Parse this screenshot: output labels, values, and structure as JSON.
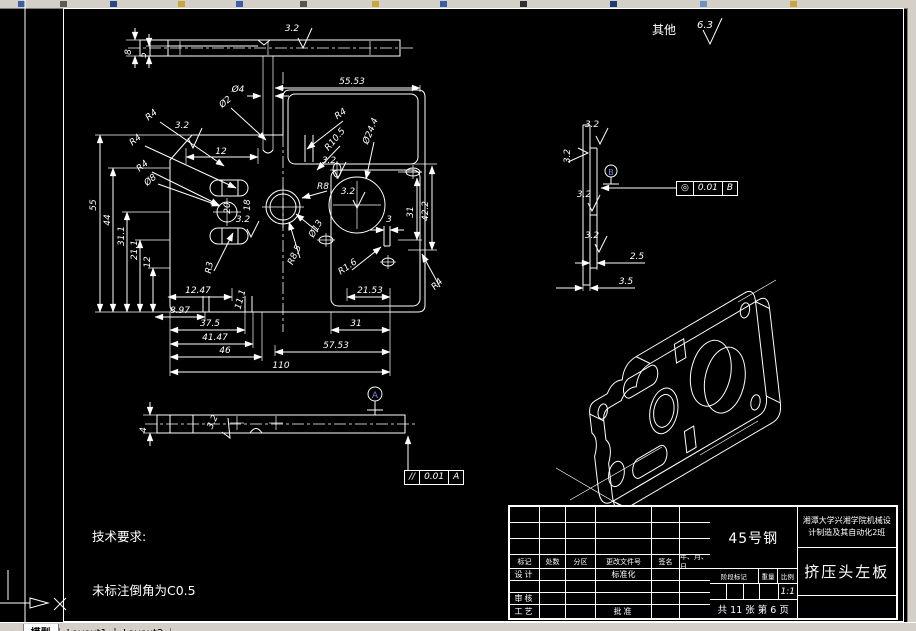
{
  "colors": {
    "line": "#ffffff",
    "bg": "#000000",
    "chrome": "#d4d0c8",
    "datum_letter": "#7a86e8"
  },
  "top_note": {
    "label": "其他",
    "roughness_value": "6.3"
  },
  "tech_req": {
    "title": "技术要求:",
    "line1": "未标注倒角为C0.5"
  },
  "tolerances": {
    "f1": {
      "symbol": "◎",
      "value": "0.01",
      "datum": "B"
    },
    "f2": {
      "symbol": "//",
      "value": "0.01",
      "datum": "A"
    }
  },
  "tabs": {
    "scroll_left": "◄",
    "scroll_right": "►",
    "items": [
      "模型",
      "Layout1",
      "Layout2"
    ]
  },
  "title_block": {
    "material": "45号钢",
    "company_line1": "湘潭大学兴湘学院机械设",
    "company_line2": "计制造及其自动化2班",
    "part_name": "挤压头左板",
    "headers": [
      "标记",
      "处数",
      "分区",
      "更改文件号",
      "签名",
      "年、月、日"
    ],
    "row_design": "设计",
    "row_standard": "标准化",
    "row_check": "审核",
    "row_process": "工艺",
    "row_approve": "批准",
    "stage_header": "阶段标记",
    "weight_header": "重量",
    "scale_header": "比例",
    "scale_value": "1:1",
    "sheet_info": "共 11 张  第 6 页"
  },
  "drawing": {
    "labels": [
      {
        "t": "其他",
        "x": 664,
        "y": 34,
        "s": 12,
        "b": 1,
        "n": "other-surfaces-label"
      },
      {
        "t": "6.3",
        "x": 705,
        "y": 28,
        "s": 10,
        "n": "default-roughness-value"
      },
      {
        "t": "8",
        "x": 131,
        "y": 52,
        "r": -90
      },
      {
        "t": "5",
        "x": 146,
        "y": 55,
        "r": -90
      },
      {
        "t": "3.2",
        "x": 292,
        "y": 31
      },
      {
        "t": "Ø4",
        "x": 238,
        "y": 92
      },
      {
        "t": "55.53",
        "x": 352,
        "y": 84
      },
      {
        "t": "12",
        "x": 221,
        "y": 154
      },
      {
        "t": "55",
        "x": 96,
        "y": 205,
        "r": -90
      },
      {
        "t": "44",
        "x": 110,
        "y": 220,
        "r": -90
      },
      {
        "t": "31.1",
        "x": 124,
        "y": 236,
        "r": -90
      },
      {
        "t": "21.1",
        "x": 137,
        "y": 250,
        "r": -90
      },
      {
        "t": "12",
        "x": 150,
        "y": 262,
        "r": -90
      },
      {
        "t": "R4",
        "x": 153,
        "y": 117,
        "r": -40
      },
      {
        "t": "R4",
        "x": 137,
        "y": 142,
        "r": -40
      },
      {
        "t": "R4",
        "x": 144,
        "y": 168,
        "r": -40
      },
      {
        "t": "3.2",
        "x": 182,
        "y": 128
      },
      {
        "t": "Ø2",
        "x": 227,
        "y": 104,
        "r": -40
      },
      {
        "t": "Ø8",
        "x": 152,
        "y": 182,
        "r": -40
      },
      {
        "t": "R4",
        "x": 342,
        "y": 116,
        "r": -35
      },
      {
        "t": "R10.5",
        "x": 337,
        "y": 141,
        "r": -50
      },
      {
        "t": "Ø24.4",
        "x": 373,
        "y": 132,
        "r": -68
      },
      {
        "t": "3.2",
        "x": 329,
        "y": 163
      },
      {
        "t": "3.2",
        "x": 348,
        "y": 194
      },
      {
        "t": "R8",
        "x": 323,
        "y": 189
      },
      {
        "t": "Ø13",
        "x": 318,
        "y": 230,
        "r": -60
      },
      {
        "t": "R8.5",
        "x": 297,
        "y": 256,
        "r": -65
      },
      {
        "t": "R1.6",
        "x": 349,
        "y": 269,
        "r": -35
      },
      {
        "t": "R4",
        "x": 439,
        "y": 286,
        "r": -45
      },
      {
        "t": "R3",
        "x": 212,
        "y": 268,
        "r": -80
      },
      {
        "t": "3.2",
        "x": 243,
        "y": 222
      },
      {
        "t": "20",
        "x": 230,
        "y": 208,
        "r": -90
      },
      {
        "t": "18",
        "x": 250,
        "y": 205,
        "r": -90
      },
      {
        "t": "11.1",
        "x": 243,
        "y": 300,
        "r": -75
      },
      {
        "t": "12.47",
        "x": 198,
        "y": 293
      },
      {
        "t": "8.97",
        "x": 180,
        "y": 313
      },
      {
        "t": "37.5",
        "x": 210,
        "y": 326
      },
      {
        "t": "41.47",
        "x": 215,
        "y": 340
      },
      {
        "t": "46",
        "x": 225,
        "y": 353
      },
      {
        "t": "110",
        "x": 281,
        "y": 368
      },
      {
        "t": "31",
        "x": 356,
        "y": 326
      },
      {
        "t": "57.53",
        "x": 336,
        "y": 348
      },
      {
        "t": "21.53",
        "x": 370,
        "y": 293
      },
      {
        "t": "3",
        "x": 389,
        "y": 222
      },
      {
        "t": "31",
        "x": 413,
        "y": 212,
        "r": -90
      },
      {
        "t": "42.2",
        "x": 428,
        "y": 211,
        "r": -90
      },
      {
        "t": "3.2",
        "x": 570,
        "y": 156,
        "r": -90
      },
      {
        "t": "3.2",
        "x": 592,
        "y": 127
      },
      {
        "t": "3.2",
        "x": 584,
        "y": 197
      },
      {
        "t": "3.2",
        "x": 592,
        "y": 238
      },
      {
        "t": "2.5",
        "x": 637,
        "y": 259
      },
      {
        "t": "3.5",
        "x": 626,
        "y": 284
      },
      {
        "t": "4",
        "x": 146,
        "y": 430,
        "r": -90
      },
      {
        "t": "3.2",
        "x": 215,
        "y": 423,
        "r": -65
      },
      {
        "t": "A",
        "x": 375,
        "y": 398,
        "s": 9,
        "b": 1,
        "c": "#7a86e8",
        "n": "datum-a-label"
      },
      {
        "t": "B",
        "x": 611,
        "y": 175,
        "s": 8,
        "b": 1,
        "c": "#7a86e8",
        "n": "datum-b-label"
      }
    ]
  }
}
